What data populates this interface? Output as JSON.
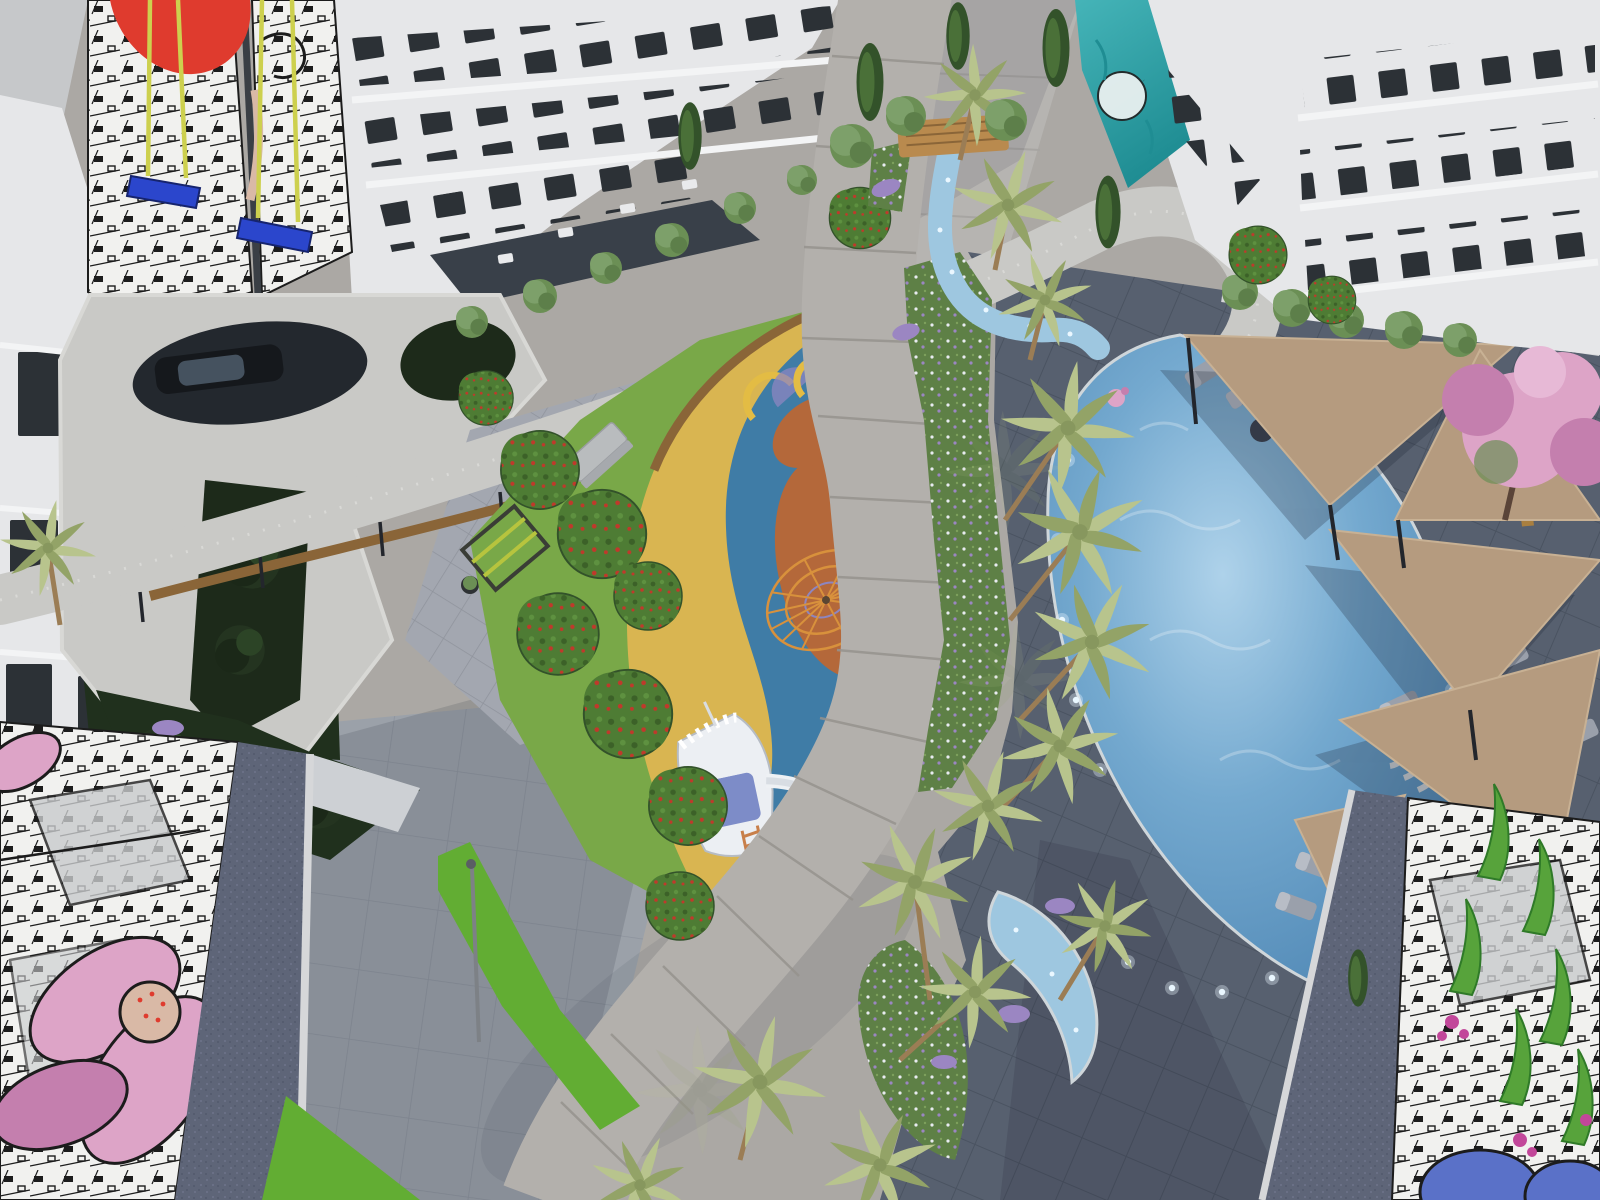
{
  "scene": {
    "kind": "aerial-architectural-render",
    "description": "Bird's-eye render of a residential complex courtyard with playground, pool, palms and facade murals",
    "objects": [
      "apartment-building-north",
      "apartment-building-east",
      "apartment-building-west",
      "mural-swing-installation",
      "comic-city-mural",
      "pink-flower-mural",
      "leaf-and-bloom-mural",
      "teal-mural",
      "children-playground",
      "ship-play-structure",
      "climbing-net",
      "tube-slide-unit",
      "fitness-frame",
      "swimming-pool",
      "kids-crescent-pool",
      "winding-stream",
      "wooden-footbridge",
      "shade-sails",
      "sun-loungers",
      "curved-bench",
      "pool-deck",
      "palm-trees",
      "cypress-trees",
      "berry-trees",
      "hedges",
      "flower-meadow",
      "lavender-patches",
      "pink-flowering-tree",
      "elevated-walkway",
      "walkway-posts",
      "timber-fence",
      "paver-court",
      "planter-pots",
      "parking-opening-with-car",
      "sunken-garden",
      "main-path",
      "concrete-bench",
      "lamp-post"
    ]
  },
  "colors": {
    "street": "#c6c8ca",
    "pavement": "#aba8a4",
    "passage": "#b6b4b1",
    "pavementCool": "#9ba1a9",
    "slabLine": "#8d939d",
    "deck": "#57606f",
    "deckLine": "#4a5361",
    "roofGravel": "#5e6578",
    "parapet": "#d6d7d9",
    "facade": "#e6e7e9",
    "facadeShade": "#cdd0d4",
    "windowDark": "#2c3136",
    "glassDark": "#394049",
    "furniture": "#e9eaec",
    "muralWhite": "#f1f1ef",
    "muralGray": "#c9cbcd",
    "muralInk": "#1c1c1c",
    "muralRed": "#df3b2e",
    "muralTeal": "#45b4b8",
    "tealDark": "#1f8d93",
    "swingBlue": "#2b46cc",
    "ropeYellow": "#cdd04e",
    "grass": "#79a848",
    "grassDark": "#5d8a3a",
    "hedge": "#62ad33",
    "treeGreen": "#4f7d3a",
    "treeDark": "#33522a",
    "courtTree": "#243420",
    "oliveGreen": "#6b8f55",
    "berryBase": "#4e7c34",
    "berryRed": "#c0392b",
    "palm": "#b8c48d",
    "palmDark": "#93a367",
    "trunk": "#9b7d55",
    "playYellow": "#d9b551",
    "playBlue": "#3f7ca6",
    "playClay": "#b4683a",
    "slideOrange": "#c06539",
    "slideYellow": "#e3bc44",
    "canopyPurple": "#8d86c0",
    "shipWhite": "#eceff3",
    "shipBlue": "#7d8cc8",
    "webOrange": "#d8913c",
    "pathLight": "#b3b0ac",
    "pathJoint": "#96938e",
    "woodDeck": "#b98a4e",
    "woodFence": "#8a6538",
    "streamBlue": "#9ec7e0",
    "poolBlue": "#74a9cf",
    "poolDeep": "#4c84b2",
    "poolPale": "#aed2ea",
    "lightDot": "#eaf7ff",
    "sailTan": "#b59b7f",
    "lounger": "#9aa0ab",
    "loungerDark": "#3c424e",
    "pinkBloom": "#dda4c7",
    "pinkDeep": "#c47fae",
    "lavender": "#9b86c2",
    "meadow": "#5e8046",
    "flowerWhite": "#e8ebf0",
    "magenta": "#c2479a",
    "leafGreen": "#57a33b",
    "leafDark": "#2f7a28",
    "muralBlue": "#5a71c8",
    "carBody": "#15181c",
    "carGlass": "#45525f",
    "bench": "#a97f3f",
    "shadow": "#1c2233",
    "potDark": "#2e3234",
    "lampGray": "#7d8186",
    "skinTone": "#d9b9a6",
    "concrete": "#b9bcbe",
    "walkway": "#c9c9c6"
  }
}
